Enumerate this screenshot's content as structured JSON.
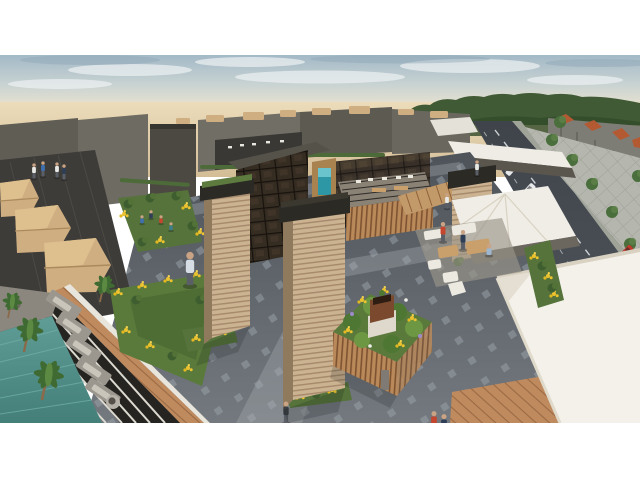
{
  "image": {
    "kind": "architectural-rendering",
    "view": "aerial-perspective",
    "subject": "mixed-use retail plaza with rooftop terraces, pool deck, landscaped planters and adjacent boulevard",
    "letterboxed": true,
    "content_area": {
      "x": 0,
      "y": 55,
      "width": 640,
      "height": 368
    }
  },
  "colors": {
    "letterbox": "#ffffff",
    "sky-top": "#a3b9c7",
    "sky-mid": "#c7d2d2",
    "sky-horizon": "#e9e2d0",
    "cloud": "#eef2f3",
    "sand-light": "#ecdcba",
    "sand-dark": "#d3bd97",
    "treeline": "#3f5a34",
    "treeline-dark": "#324a29",
    "bg-building-dark": "#55524a",
    "bg-building-mid": "#6b6860",
    "bg-building-light": "#8d8a80",
    "canopy-tan": "#cfae82",
    "canopy-shade": "#ab8a5d",
    "asphalt-top": "#3f444a",
    "asphalt-bottom": "#535960",
    "lane-line": "#cdd1d4",
    "median": "#9fa398",
    "sidewalk": "#b5b7af",
    "paver-line": "#9fa196",
    "townhouse": "#7e7d75",
    "roof-orange": "#b35a33",
    "plaza-top": "#4e535a",
    "plaza-bottom": "#73797f",
    "plaza-dot": "#9ba3a9",
    "walkway-light": "#a9aeb2",
    "pool-top": "#5f9d96",
    "pool-bottom": "#447f79",
    "deck-gray": "#8b877f",
    "lounger": "#c9c5bb",
    "lawn": "#5a7a3c",
    "lawn-dark": "#46622e",
    "bush": "#3f5e2f",
    "flower-yellow": "#ecc32f",
    "flower-purple": "#9d8cc9",
    "flower-white": "#eef0e8",
    "palm-green": "#3f6b33",
    "trunk-brown": "#8a6a4a",
    "tower-face": "#cbb291",
    "tower-stripe": "#a5896a",
    "tower-side": "#8f7a5d",
    "tower-cap": "#2c2a25",
    "sedum-green": "#5d7b3f",
    "glass-dark": "#352c22",
    "mullion": "#17120d",
    "wood-slat": "#b9895a",
    "wood-slat-dark": "#7d5331",
    "clay-coping": "#bf8a5e",
    "white-roof": "#f3f1ea",
    "white-shade": "#d9d2c2",
    "banner-teal": "#2e97a5",
    "banner-teal-light": "#6ac4cd",
    "skin": "#caa284",
    "person-blue": "#3f6fae",
    "person-lightblue": "#9fb6cf",
    "person-white": "#e8e8e4",
    "person-navy": "#2e3e57",
    "person-red": "#c5452f",
    "car-white": "#e6e8e9",
    "car-dark": "#3a3f45",
    "car-red": "#c03b2c",
    "shadow": "rgba(18,20,22,0.32)"
  },
  "scene_elements": [
    "sky with thin clouds",
    "desert horizon",
    "distant tree line",
    "boulevard with cars and median",
    "paver esplanade with street trees",
    "townhouses with orange roofs",
    "checker-dot plaza paving",
    "striped stone towers with dark caps",
    "bronze glass atrium",
    "wood-slat pavilion with rooftop dining",
    "teal banner",
    "tan faceted tent canopies",
    "rooftop pool with cabana loungers and palms",
    "lawn and flower beds",
    "wood-slat planter box with flowers",
    "white tensile canopy",
    "large white roof building",
    "outdoor lounge furniture",
    "pedestrian figures"
  ]
}
